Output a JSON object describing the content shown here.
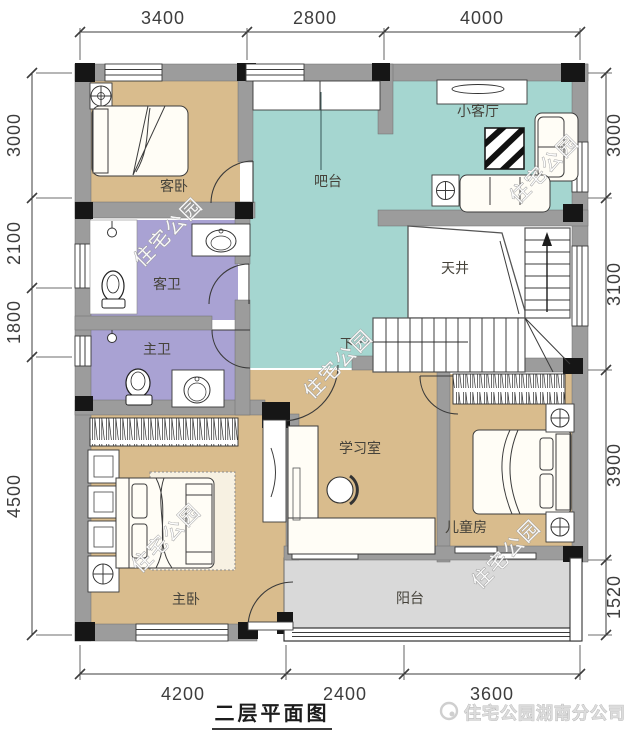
{
  "plan": {
    "title": "二层平面图",
    "company": "住宅公园湖南分公司",
    "watermark": "住宅公园",
    "rooms": {
      "guest_bedroom": "客卧",
      "bar": "吧台",
      "small_living": "小客厅",
      "guest_bath": "客卫",
      "light_well": "天井",
      "master_bath": "主卫",
      "study": "学习室",
      "kids_room": "儿童房",
      "master_bedroom": "主卧",
      "balcony": "阳台",
      "stairs_down": "下"
    },
    "dimensions": {
      "top": [
        "3400",
        "2800",
        "4000"
      ],
      "bottom": [
        "4200",
        "2400",
        "3600"
      ],
      "left": [
        "3000",
        "2100",
        "1800",
        "4500"
      ],
      "right": [
        "3000",
        "3100",
        "3900",
        "1520"
      ]
    },
    "colors": {
      "bedroom_tan": "#d9bc8d",
      "living_teal": "#a5d6d0",
      "bath_purple": "#a9a2d3",
      "balcony_gray": "#d9d9d9",
      "wall_gray": "#9c9c9c",
      "column_black": "#161616"
    }
  }
}
